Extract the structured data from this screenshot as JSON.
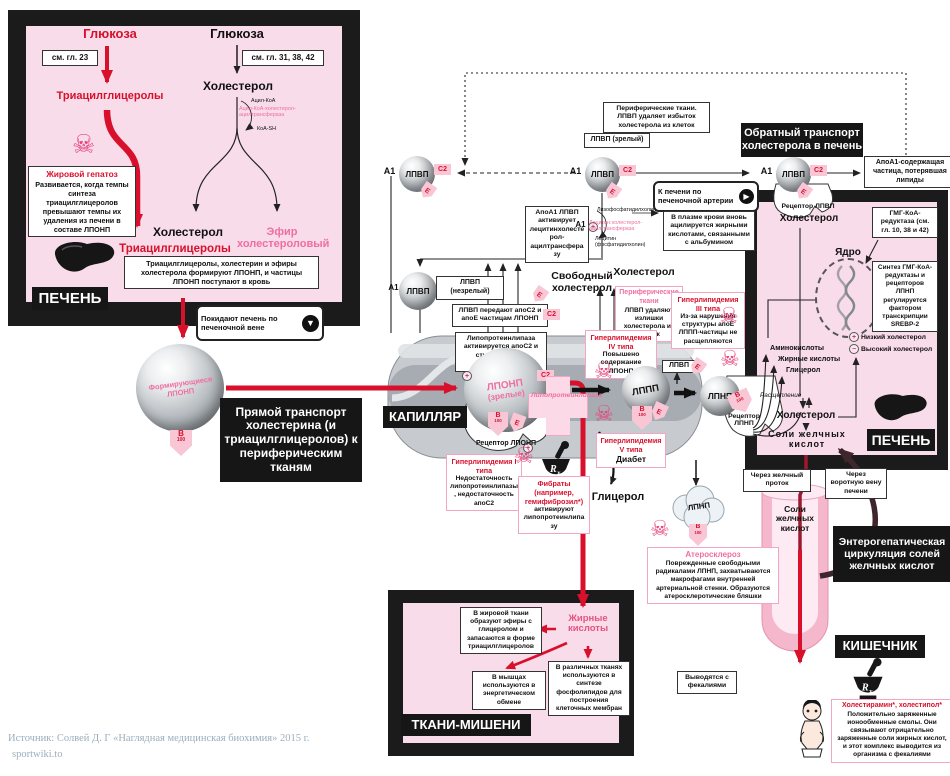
{
  "colors": {
    "accent_red": "#d8102c",
    "accent_pink": "#ef6ea1",
    "panel_pink": "#f8dcea",
    "frame_black": "#1b1b1b",
    "tag_pink_bg": "#f9c6d6",
    "capillary_gray": "#c7cbcf"
  },
  "icons": {
    "skull": "☠",
    "plus": "+",
    "minus": "−",
    "down_arrow": "▼",
    "right_arrow": "▶",
    "rx": "Rx"
  },
  "tags": {
    "a1": "А1",
    "c2": "С2",
    "e": "Е",
    "b": "B",
    "n100": "100"
  },
  "particles": {
    "vldl_name": "ЛПОНП",
    "vldl_state": "(зрелые)",
    "idl": "ЛППП",
    "ldl": "ЛПНП",
    "hdl": "ЛПВП",
    "forming": "Формирующиеся ЛПОНП"
  },
  "left_liver": {
    "label": "ПЕЧЕНЬ",
    "glucose1": "Глюкоза",
    "ref1": "см. гл. 23",
    "tri1": "Триацилглицеролы",
    "fatty_title": "Жировой гепатоз",
    "fatty_body": "Развивается, когда темпы синтеза триацилглицеролов превышают темпы их удаления из печени в составе ЛПОНП",
    "glucose2": "Глюкоза",
    "ref2": "см. гл. 31, 38, 42",
    "chol1": "Холестерол",
    "acyl_coa": "Ацил-КоА",
    "acat": "Ацил-КоА-холестерол-ацилтрансфераза",
    "coa_sh": "КоА-SH",
    "chol_out": "Холестерол",
    "chol_ester": "Эфир холестероловый",
    "tri2": "Триацилглицеролы",
    "note": "Триацилглицеролы, холестерин и эфиры холестерола формируют ЛПОНП, и частицы ЛПОНП поступают в кровь",
    "exit": "Покидают печень по печеночной вене"
  },
  "mid": {
    "direct": "Прямой транспорт холестерина (и триацилглицеролов) к периферическим тканям",
    "capillary": "КАПИЛЛЯР",
    "lpl_box": "Липопротеинлипаза активируется апоС2 и стимулируется инсулином",
    "transfer_box": "ЛПВП передают апоС2 и апоЕ частицам ЛПОНП",
    "lpl_cross": "Липопротеинлипаза",
    "receptor_vldl": "Рецептор ЛПОНП",
    "receptor_ldl": "Рецептор ЛПНП",
    "free_chol": "Свободный холестерол",
    "chol": "Холестерол",
    "peripheral2_t": "Периферические ткани",
    "peripheral2_b": "ЛПВП удаляют излишки холестерола из клеток",
    "hyper1_t": "Гиперлипидемия I типа",
    "hyper1_b": "Недостаточность липопротеинлипазы, недостаточность апоС2",
    "hyper3_t": "Гиперлипидемия III типа",
    "hyper3_b": "Из-за нарушения структуры апоЕ ЛППП-частицы не расщепляются",
    "hyper4_t": "Гиперлипидемия IV типа",
    "hyper4_b": "Повышено содержание ЛПОНП",
    "hyper5_t": "Гиперлипидемия V типа",
    "hyper5_b": "Диабет",
    "fibrates_t": "Фибраты (например, гемифиброзил*)",
    "fibrates_b": "активируют липопротеинлипазу",
    "glycerol": "Глицерол",
    "athero_t": "Атеросклероз",
    "athero_b": "Поврежденные свободными радикалами ЛПНП, захватываются макрофагами внутренней артериальной стенки. Образуются атеросклеротические бляшки"
  },
  "hdl": {
    "mature_box": "ЛПВП (зрелый)",
    "immature_box": "ЛПВП (незрелый)",
    "peripheral_top": "Периферические ткани. ЛПВП удаляет избыток холестерола из клеток",
    "reverse": "Обратный транспорт холестерола в печень",
    "lcat_box": "АпоА1 ЛПВП активирует лецитинхолестерол-ацилтрансферазу",
    "lyso": "Лизофосфатидилхолин",
    "lcat": "Лецитин:холестерол-ацилтрансфераза",
    "lecithin": "Лецитин (фосфатидилхолин)",
    "artery": "К печени по печеночной артерии",
    "plasma": "В плазме крови вновь ацилируется жирными кислотами, связанными с альбумином",
    "apoa1_box": "АпоА1-содержащая частица, потерявшая липиды",
    "receptor_hdl": "Рецептор ЛПВП"
  },
  "right_liver": {
    "label": "ПЕЧЕНЬ",
    "chol_top": "Холестерол",
    "hmg": "ГМГ-КоА-редуктаза (см. гл. 10, 38 и 42)",
    "nucleus": "Ядро",
    "srebp": "Синтез ГМГ-КоА-редуктазы и рецепторов ЛПНП регулируется фактором транскрипции SREBP-2",
    "low": "Низкий холестерол",
    "high": "Высокий холестерол",
    "amino": "Аминокислоты",
    "fatty": "Жирные кислоты",
    "glycerol": "Глицерол",
    "cleave": "Расщепление",
    "chol_mid": "Холестерол",
    "bile": "Соли желчных кислот"
  },
  "intestine": {
    "label": "КИШЕЧНИК",
    "duct": "Через желчный проток",
    "portal": "Через воротную вену печени",
    "bile_tube": "Соли желчных кислот",
    "entero": "Энтерогепатическая циркуляция солей желчных кислот",
    "feces": "Выводятся с фекалиями",
    "resins_t": "Холестирамин*, холестипол*",
    "resins_b": "Положительно заряженные ионообменные смолы. Они связывают отрицательно заряженные соли жирных кислот, и этот комплекс выводится из организма с фекалиями"
  },
  "tissues": {
    "label": "ТКАНИ-МИШЕНИ",
    "fatty": "Жирные кислоты",
    "adipose": "В жировой ткани образуют эфиры с глицеролом и запасаются в форме триацилглицеролов",
    "muscle": "В мышцах используются в энергетическом обмене",
    "membranes": "В различных тканях используются в синтезе фосфолипидов для построения клеточных мембран"
  },
  "source": {
    "line1": "Источник: Солвей Д. Г «Наглядная медицинская биохимия» 2015 г.",
    "line2": "sportwiki.to"
  }
}
